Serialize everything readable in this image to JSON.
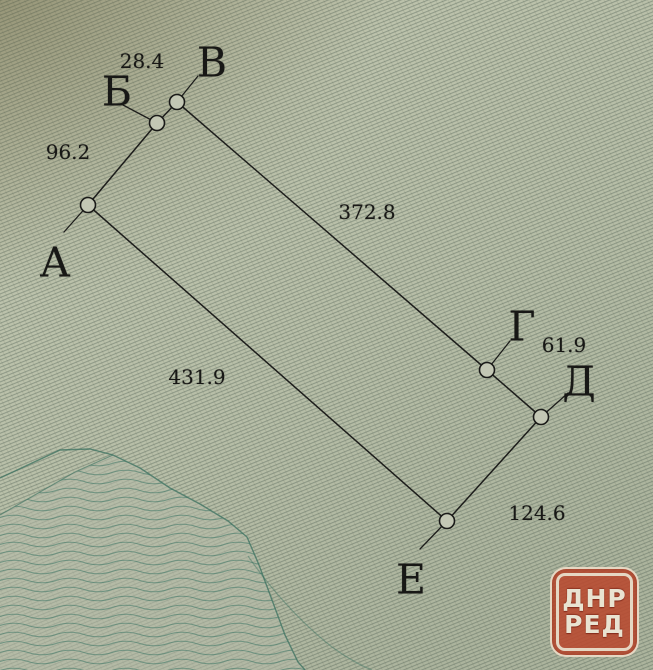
{
  "diagram": {
    "kind": "land-plot-survey-sketch",
    "vertices": [
      {
        "id": "A",
        "label": "А"
      },
      {
        "id": "B",
        "label": "Б"
      },
      {
        "id": "V",
        "label": "В"
      },
      {
        "id": "G",
        "label": "Г"
      },
      {
        "id": "D",
        "label": "Д"
      },
      {
        "id": "E",
        "label": "Е"
      }
    ],
    "sides": [
      {
        "from": "А",
        "to": "Б",
        "length": "96.2"
      },
      {
        "from": "Б",
        "to": "В",
        "length": "28.4"
      },
      {
        "from": "В",
        "to": "Г",
        "length": "372.8"
      },
      {
        "from": "Г",
        "to": "Д",
        "length": "61.9"
      },
      {
        "from": "Д",
        "to": "Е",
        "length": "124.6"
      },
      {
        "from": "Е",
        "to": "А",
        "length": "431.9"
      }
    ]
  },
  "watermark": {
    "line1": "ДНР",
    "line2": "РЕД",
    "red": "#b8492f",
    "cream": "#e9e3d1"
  },
  "colors": {
    "paper": "#b9bfa9",
    "paper_top": "#b2b296",
    "hatch": "#5c6c60",
    "contour_teal": "#3f7767",
    "ink": "#1d1d1b"
  }
}
